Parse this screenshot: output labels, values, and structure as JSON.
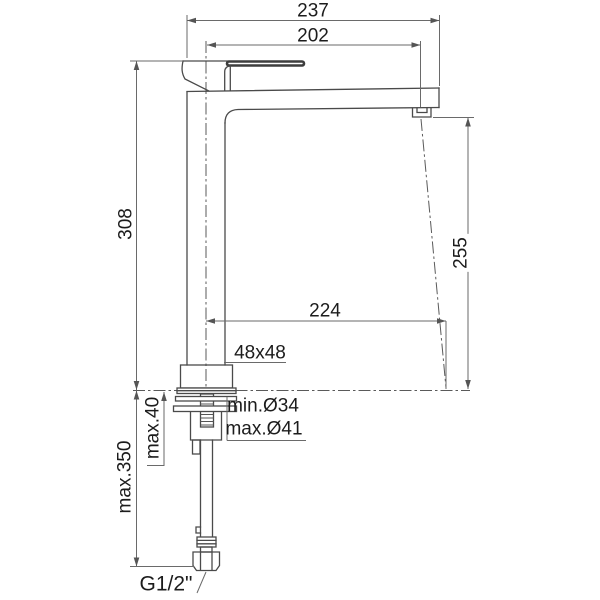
{
  "drawing": {
    "title": "faucet-technical-drawing",
    "dimensions": {
      "overall_width": "237",
      "spout_projection_top": "202",
      "body_height": "308",
      "spout_outlet_height": "255",
      "outlet_reach": "224",
      "body_section": "48x48",
      "hole_min": "min.Ø34",
      "hole_max": "max.Ø41",
      "deck_thickness": "max.40",
      "hose_length": "max.350",
      "connection_thread": "G1/2\""
    },
    "colors": {
      "line": "#4a4a4a",
      "dimension_line": "#6a6a6a",
      "text": "#1c1c1c",
      "background": "#ffffff"
    }
  }
}
